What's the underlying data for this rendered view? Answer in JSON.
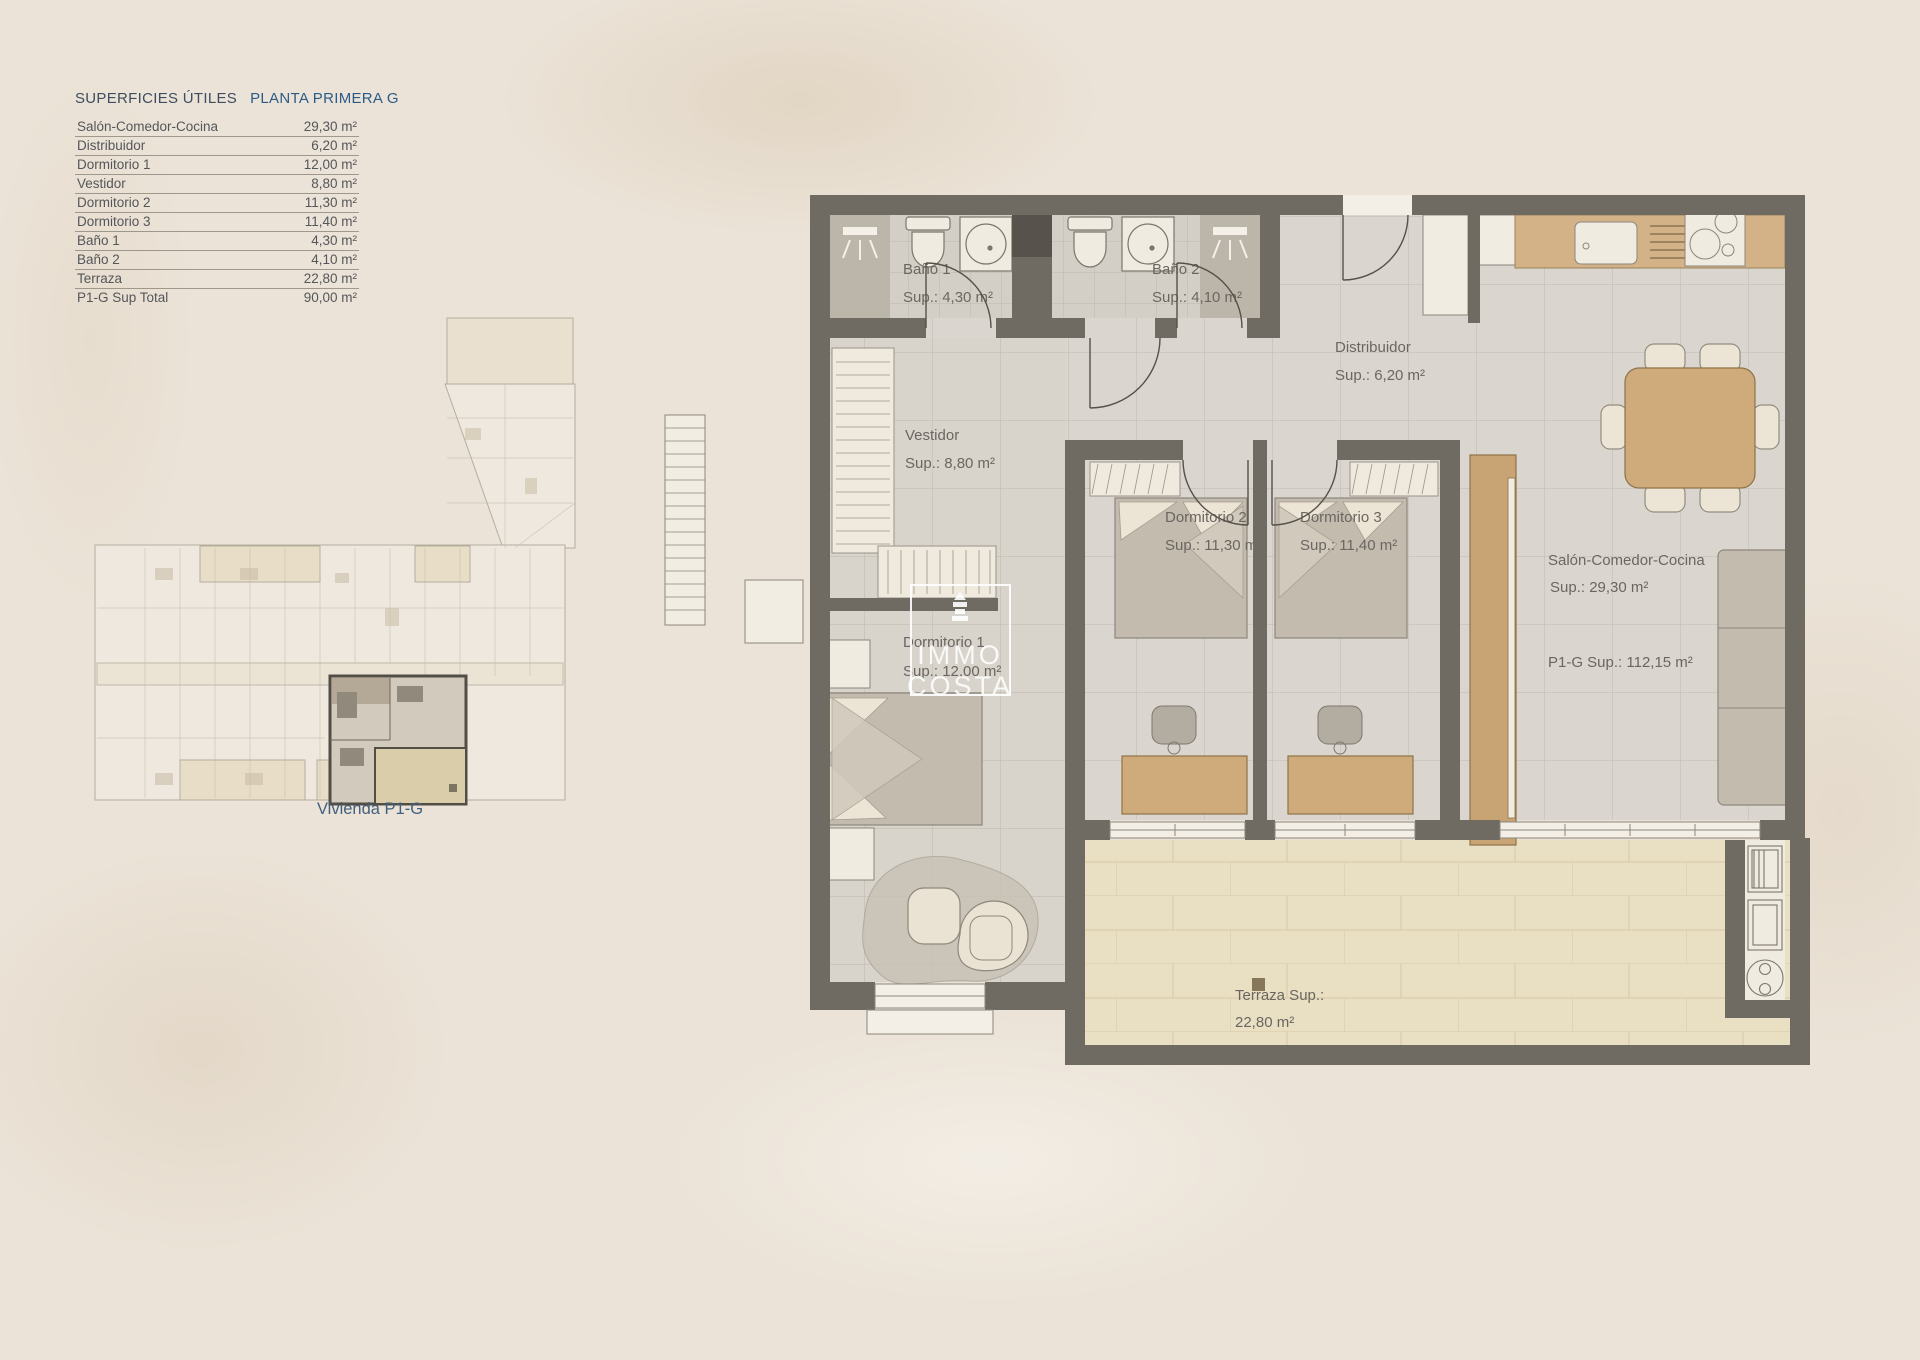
{
  "colors": {
    "accent_blue": "#2b5c88",
    "caption_blue": "#41607f",
    "wall": "#6f6b63",
    "floor": "#dad5ce",
    "terrace": "#e9dfc3",
    "wood": "#cfa977",
    "background": "#ebe3d7"
  },
  "table": {
    "title": "SUPERFICIES ÚTILES",
    "subtitle": "PLANTA PRIMERA G",
    "rows": [
      {
        "label": "Salón-Comedor-Cocina",
        "value": "29,30 m²"
      },
      {
        "label": "Distribuidor",
        "value": "6,20 m²"
      },
      {
        "label": "Dormitorio 1",
        "value": "12,00 m²"
      },
      {
        "label": "Vestidor",
        "value": "8,80 m²"
      },
      {
        "label": "Dormitorio 2",
        "value": "11,30 m²"
      },
      {
        "label": "Dormitorio 3",
        "value": "11,40 m²"
      },
      {
        "label": "Baño 1",
        "value": "4,30 m²"
      },
      {
        "label": "Baño 2",
        "value": "4,10 m²"
      },
      {
        "label": "Terraza",
        "value": "22,80 m²"
      },
      {
        "label": "P1-G Sup Total",
        "value": "90,00 m²"
      }
    ]
  },
  "overview": {
    "caption": "Vivienda P1-G"
  },
  "plan": {
    "labels": {
      "bano1": {
        "name": "Baño 1",
        "sup": "Sup.: 4,30 m²"
      },
      "bano2": {
        "name": "Baño 2",
        "sup": "Sup.: 4,10 m²"
      },
      "distribuidor": {
        "name": "Distribuidor",
        "sup": "Sup.: 6,20 m²"
      },
      "vestidor": {
        "name": "Vestidor",
        "sup": "Sup.: 8,80 m²"
      },
      "dormitorio1": {
        "name": "Dormitorio 1",
        "sup": "Sup.: 12,00 m²"
      },
      "dormitorio2": {
        "name": "Dormitorio 2",
        "sup": "Sup.: 11,30 m²"
      },
      "dormitorio3": {
        "name": "Dormitorio 3",
        "sup": "Sup.: 11,40 m²"
      },
      "salon": {
        "name": "Salón-Comedor-Cocina",
        "sup": "Sup.: 29,30 m²"
      },
      "total": {
        "name": "P1-G Sup.: 112,15 m²"
      },
      "terraza": {
        "name": "Terraza Sup.:",
        "sup": "22,80 m²"
      }
    },
    "watermark": {
      "line1": "IMMO",
      "line2": "COSTA"
    }
  }
}
